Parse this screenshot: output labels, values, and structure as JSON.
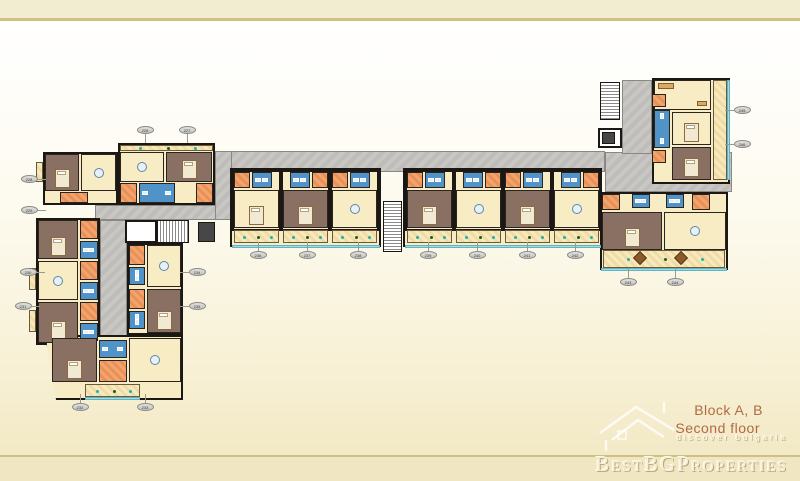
{
  "branding": {
    "block_title": "Block A, B",
    "floor_title": "Second floor",
    "tagline": "discover bulgaria",
    "watermark": "BestBGProperties",
    "title_color": "#b26a44"
  },
  "plan": {
    "colors": {
      "wall": "#1b1713",
      "floor_cream": "#f8ecc4",
      "bedroom_mauve": "#8a7063",
      "bathroom_blue": "#4f93c8",
      "entry_orange": "#f2a36e",
      "corridor_gray": "#c9c7c4",
      "terrace_edge_teal": "#a3dbe4",
      "plant_teal": "#1fb3ab",
      "plant_green": "#1e5c1e"
    },
    "corridors": [
      {
        "x": 215,
        "y": 151,
        "w": 390,
        "h": 21
      },
      {
        "x": 605,
        "y": 152,
        "w": 127,
        "h": 40
      },
      {
        "x": 622,
        "y": 80,
        "w": 30,
        "h": 74
      },
      {
        "x": 95,
        "y": 205,
        "w": 137,
        "h": 15
      },
      {
        "x": 215,
        "y": 151,
        "w": 17,
        "h": 69
      },
      {
        "x": 100,
        "y": 220,
        "w": 27,
        "h": 125
      }
    ],
    "blocks": [
      {
        "x": 118,
        "y": 143,
        "w": 97,
        "h": 62
      },
      {
        "x": 43,
        "y": 152,
        "w": 75,
        "h": 53
      },
      {
        "x": 36,
        "y": 218,
        "w": 64,
        "h": 127
      },
      {
        "x": 127,
        "y": 243,
        "w": 56,
        "h": 92
      },
      {
        "x": 45,
        "y": 335,
        "w": 138,
        "h": 65,
        "clip": "polygon(0 0,100% 0,100% 100%,8% 100%)"
      },
      {
        "x": 230,
        "y": 168,
        "w": 151,
        "h": 79
      },
      {
        "x": 403,
        "y": 168,
        "w": 199,
        "h": 79
      },
      {
        "x": 600,
        "y": 192,
        "w": 128,
        "h": 78
      },
      {
        "x": 652,
        "y": 78,
        "w": 78,
        "h": 106
      }
    ],
    "white_boxes": [
      {
        "x": 598,
        "y": 128,
        "w": 24,
        "h": 20
      },
      {
        "x": 125,
        "y": 220,
        "w": 32,
        "h": 23
      }
    ],
    "elevators": [
      {
        "x": 602,
        "y": 132,
        "w": 13,
        "h": 12
      },
      {
        "x": 198,
        "y": 222,
        "w": 17,
        "h": 20
      }
    ],
    "stairs": [
      {
        "x": 157,
        "y": 220,
        "w": 32,
        "h": 23,
        "dir": "v"
      },
      {
        "x": 383,
        "y": 201,
        "w": 19,
        "h": 51,
        "dir": "h"
      },
      {
        "x": 600,
        "y": 82,
        "w": 20,
        "h": 38,
        "dir": "h"
      }
    ],
    "rooms": [
      {
        "x": 120,
        "y": 145,
        "w": 93,
        "h": 6,
        "t": "balcony"
      },
      {
        "x": 120,
        "y": 152,
        "w": 44,
        "h": 30,
        "t": "cream",
        "f": "table"
      },
      {
        "x": 166,
        "y": 152,
        "w": 46,
        "h": 30,
        "t": "mauve",
        "f": "bed"
      },
      {
        "x": 120,
        "y": 183,
        "w": 17,
        "h": 20,
        "t": "orange"
      },
      {
        "x": 139,
        "y": 183,
        "w": 36,
        "h": 20,
        "t": "blue",
        "f": "fix"
      },
      {
        "x": 196,
        "y": 183,
        "w": 17,
        "h": 20,
        "t": "orange"
      },
      {
        "x": 45,
        "y": 154,
        "w": 34,
        "h": 37,
        "t": "mauve",
        "f": "bed"
      },
      {
        "x": 81,
        "y": 154,
        "w": 35,
        "h": 37,
        "t": "cream",
        "f": "table"
      },
      {
        "x": 60,
        "y": 192,
        "w": 28,
        "h": 11,
        "t": "orange"
      },
      {
        "x": 36,
        "y": 162,
        "w": 7,
        "h": 20,
        "t": "balcony"
      },
      {
        "x": 38,
        "y": 220,
        "w": 40,
        "h": 39,
        "t": "mauve",
        "f": "bed"
      },
      {
        "x": 80,
        "y": 220,
        "w": 18,
        "h": 19,
        "t": "orange"
      },
      {
        "x": 80,
        "y": 241,
        "w": 18,
        "h": 18,
        "t": "blue",
        "f": "fix"
      },
      {
        "x": 38,
        "y": 261,
        "w": 40,
        "h": 39,
        "t": "cream",
        "f": "table"
      },
      {
        "x": 80,
        "y": 261,
        "w": 18,
        "h": 19,
        "t": "orange"
      },
      {
        "x": 80,
        "y": 282,
        "w": 18,
        "h": 18,
        "t": "blue",
        "f": "fix"
      },
      {
        "x": 38,
        "y": 302,
        "w": 40,
        "h": 41,
        "t": "mauve",
        "f": "bed"
      },
      {
        "x": 80,
        "y": 302,
        "w": 18,
        "h": 19,
        "t": "orange"
      },
      {
        "x": 80,
        "y": 323,
        "w": 18,
        "h": 18,
        "t": "blue",
        "f": "fix"
      },
      {
        "x": 29,
        "y": 268,
        "w": 7,
        "h": 22,
        "t": "balcony"
      },
      {
        "x": 29,
        "y": 310,
        "w": 7,
        "h": 22,
        "t": "balcony"
      },
      {
        "x": 129,
        "y": 245,
        "w": 16,
        "h": 20,
        "t": "orange"
      },
      {
        "x": 129,
        "y": 267,
        "w": 16,
        "h": 18,
        "t": "blue",
        "f": "fix"
      },
      {
        "x": 147,
        "y": 245,
        "w": 34,
        "h": 42,
        "t": "cream",
        "f": "table"
      },
      {
        "x": 129,
        "y": 289,
        "w": 16,
        "h": 20,
        "t": "orange"
      },
      {
        "x": 129,
        "y": 311,
        "w": 16,
        "h": 18,
        "t": "blue",
        "f": "fix"
      },
      {
        "x": 147,
        "y": 289,
        "w": 34,
        "h": 44,
        "t": "mauve",
        "f": "bed"
      },
      {
        "x": 52,
        "y": 338,
        "w": 45,
        "h": 44,
        "t": "mauve",
        "f": "bed"
      },
      {
        "x": 99,
        "y": 340,
        "w": 28,
        "h": 18,
        "t": "blue",
        "f": "fix"
      },
      {
        "x": 99,
        "y": 360,
        "w": 28,
        "h": 22,
        "t": "orange"
      },
      {
        "x": 129,
        "y": 338,
        "w": 52,
        "h": 44,
        "t": "cream",
        "f": "table"
      },
      {
        "x": 85,
        "y": 384,
        "w": 55,
        "h": 13,
        "t": "balcony"
      },
      {
        "x": 602,
        "y": 194,
        "w": 18,
        "h": 16,
        "t": "orange"
      },
      {
        "x": 632,
        "y": 194,
        "w": 18,
        "h": 14,
        "t": "blue",
        "f": "fix"
      },
      {
        "x": 602,
        "y": 212,
        "w": 60,
        "h": 38,
        "t": "mauve",
        "f": "bed"
      },
      {
        "x": 666,
        "y": 194,
        "w": 18,
        "h": 14,
        "t": "blue",
        "f": "fix"
      },
      {
        "x": 692,
        "y": 194,
        "w": 18,
        "h": 16,
        "t": "orange"
      },
      {
        "x": 664,
        "y": 212,
        "w": 62,
        "h": 38,
        "t": "cream",
        "f": "table"
      },
      {
        "x": 603,
        "y": 250,
        "w": 122,
        "h": 18,
        "t": "balcony",
        "f": "dtables"
      },
      {
        "x": 713,
        "y": 80,
        "w": 14,
        "h": 100,
        "t": "balcony"
      },
      {
        "x": 654,
        "y": 80,
        "w": 57,
        "h": 30,
        "t": "cream",
        "f": "sofa"
      },
      {
        "x": 652,
        "y": 94,
        "w": 14,
        "h": 13,
        "t": "orange"
      },
      {
        "x": 654,
        "y": 110,
        "w": 16,
        "h": 38,
        "t": "blue",
        "f": "fix"
      },
      {
        "x": 672,
        "y": 112,
        "w": 39,
        "h": 33,
        "t": "cream",
        "f": "bed"
      },
      {
        "x": 652,
        "y": 150,
        "w": 14,
        "h": 13,
        "t": "orange"
      },
      {
        "x": 672,
        "y": 147,
        "w": 39,
        "h": 33,
        "t": "mauve",
        "f": "bed"
      }
    ],
    "units_mid": [
      {
        "x": 232,
        "main": "cream",
        "bed": 1,
        "flip": 0
      },
      {
        "x": 281,
        "main": "mauve",
        "bed": 1,
        "flip": 1
      },
      {
        "x": 330,
        "main": "cream",
        "bed": 0,
        "flip": 0
      },
      {
        "x": 405,
        "main": "mauve",
        "bed": 1,
        "flip": 0
      },
      {
        "x": 454,
        "main": "cream",
        "bed": 0,
        "flip": 1
      },
      {
        "x": 503,
        "main": "mauve",
        "bed": 1,
        "flip": 0
      },
      {
        "x": 552,
        "main": "cream",
        "bed": 0,
        "flip": 1
      }
    ],
    "unit_geom": {
      "y": 170,
      "w": 49,
      "h": 75
    },
    "terrace_edges": [
      {
        "x": 232,
        "y": 245,
        "w": 148,
        "h": 3
      },
      {
        "x": 405,
        "y": 245,
        "w": 196,
        "h": 3
      },
      {
        "x": 601,
        "y": 268,
        "w": 126,
        "h": 3
      },
      {
        "x": 85,
        "y": 397,
        "w": 55,
        "h": 3
      },
      {
        "x": 727,
        "y": 80,
        "w": 3,
        "h": 100
      }
    ],
    "labels": [
      {
        "x": 145,
        "y": 130,
        "n": "226",
        "dir": "down"
      },
      {
        "x": 187,
        "y": 130,
        "n": "227",
        "dir": "down"
      },
      {
        "x": 29,
        "y": 179,
        "n": "228",
        "dir": "right"
      },
      {
        "x": 29,
        "y": 210,
        "n": "229",
        "dir": "right"
      },
      {
        "x": 28,
        "y": 272,
        "n": "230",
        "dir": "right"
      },
      {
        "x": 23,
        "y": 306,
        "n": "231",
        "dir": "right"
      },
      {
        "x": 80,
        "y": 407,
        "n": "232",
        "dir": "up"
      },
      {
        "x": 145,
        "y": 407,
        "n": "233",
        "dir": "up"
      },
      {
        "x": 197,
        "y": 272,
        "n": "234",
        "dir": "left"
      },
      {
        "x": 197,
        "y": 306,
        "n": "235",
        "dir": "left"
      },
      {
        "x": 258,
        "y": 255,
        "n": "236",
        "dir": "up"
      },
      {
        "x": 307,
        "y": 255,
        "n": "237",
        "dir": "up"
      },
      {
        "x": 358,
        "y": 255,
        "n": "238",
        "dir": "up"
      },
      {
        "x": 428,
        "y": 255,
        "n": "239",
        "dir": "up"
      },
      {
        "x": 477,
        "y": 255,
        "n": "240",
        "dir": "up"
      },
      {
        "x": 527,
        "y": 255,
        "n": "241",
        "dir": "up"
      },
      {
        "x": 575,
        "y": 255,
        "n": "242",
        "dir": "up"
      },
      {
        "x": 628,
        "y": 282,
        "n": "243",
        "dir": "up"
      },
      {
        "x": 675,
        "y": 282,
        "n": "244",
        "dir": "up"
      },
      {
        "x": 742,
        "y": 110,
        "n": "245",
        "dir": "left"
      },
      {
        "x": 742,
        "y": 144,
        "n": "246",
        "dir": "left"
      }
    ]
  }
}
